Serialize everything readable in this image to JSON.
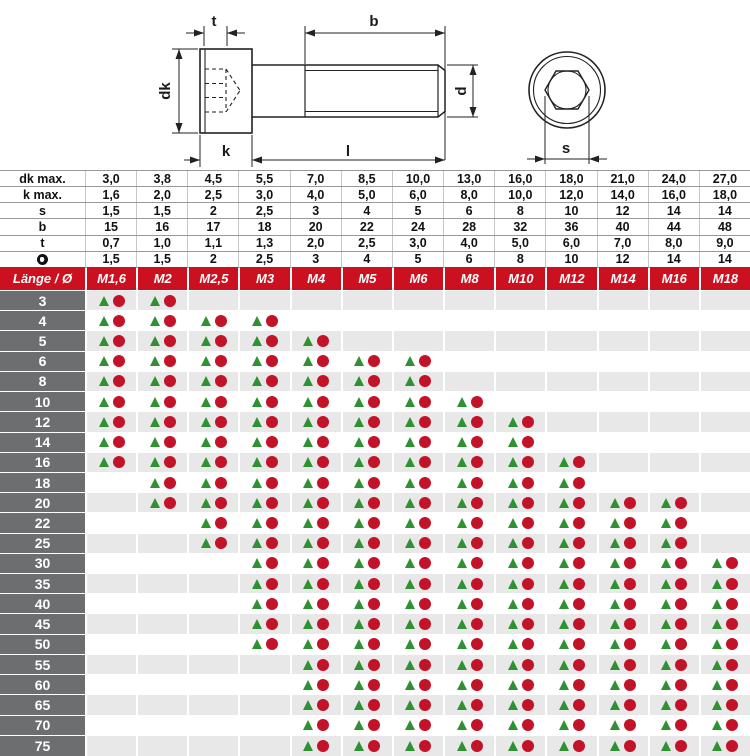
{
  "drawing": {
    "labels": {
      "socket_depth": "t",
      "thread_length": "b",
      "head_diameter": "dk",
      "shank_diameter": "d",
      "head_height": "k",
      "total_length": "l",
      "hex_width": "s"
    }
  },
  "spec_table": {
    "rows": [
      {
        "label": "dk max.",
        "values": [
          "3,0",
          "3,8",
          "4,5",
          "5,5",
          "7,0",
          "8,5",
          "10,0",
          "13,0",
          "16,0",
          "18,0",
          "21,0",
          "24,0",
          "27,0"
        ]
      },
      {
        "label": "k max.",
        "values": [
          "1,6",
          "2,0",
          "2,5",
          "3,0",
          "4,0",
          "5,0",
          "6,0",
          "8,0",
          "10,0",
          "12,0",
          "14,0",
          "16,0",
          "18,0"
        ]
      },
      {
        "label": "s",
        "values": [
          "1,5",
          "1,5",
          "2",
          "2,5",
          "3",
          "4",
          "5",
          "6",
          "8",
          "10",
          "12",
          "14",
          "14"
        ]
      },
      {
        "label": "b",
        "values": [
          "15",
          "16",
          "17",
          "18",
          "20",
          "22",
          "24",
          "28",
          "32",
          "36",
          "40",
          "44",
          "48"
        ]
      },
      {
        "label": "t",
        "values": [
          "0,7",
          "1,0",
          "1,1",
          "1,3",
          "2,0",
          "2,5",
          "3,0",
          "4,0",
          "5,0",
          "6,0",
          "7,0",
          "8,0",
          "9,0"
        ]
      },
      {
        "label": "",
        "icon": "hex-socket-icon",
        "values": [
          "1,5",
          "1,5",
          "2",
          "2,5",
          "3",
          "4",
          "5",
          "6",
          "8",
          "10",
          "12",
          "14",
          "14"
        ]
      }
    ]
  },
  "matrix": {
    "corner_label": "Länge / Ø",
    "columns": [
      "M1,6",
      "M2",
      "M2,5",
      "M3",
      "M4",
      "M5",
      "M6",
      "M8",
      "M10",
      "M12",
      "M14",
      "M16",
      "M18"
    ],
    "rows": [
      {
        "length": "3",
        "available": [
          1,
          1,
          0,
          0,
          0,
          0,
          0,
          0,
          0,
          0,
          0,
          0,
          0
        ]
      },
      {
        "length": "4",
        "available": [
          1,
          1,
          1,
          1,
          0,
          0,
          0,
          0,
          0,
          0,
          0,
          0,
          0
        ]
      },
      {
        "length": "5",
        "available": [
          1,
          1,
          1,
          1,
          1,
          0,
          0,
          0,
          0,
          0,
          0,
          0,
          0
        ]
      },
      {
        "length": "6",
        "available": [
          1,
          1,
          1,
          1,
          1,
          1,
          1,
          0,
          0,
          0,
          0,
          0,
          0
        ]
      },
      {
        "length": "8",
        "available": [
          1,
          1,
          1,
          1,
          1,
          1,
          1,
          0,
          0,
          0,
          0,
          0,
          0
        ]
      },
      {
        "length": "10",
        "available": [
          1,
          1,
          1,
          1,
          1,
          1,
          1,
          1,
          0,
          0,
          0,
          0,
          0
        ]
      },
      {
        "length": "12",
        "available": [
          1,
          1,
          1,
          1,
          1,
          1,
          1,
          1,
          1,
          0,
          0,
          0,
          0
        ]
      },
      {
        "length": "14",
        "available": [
          1,
          1,
          1,
          1,
          1,
          1,
          1,
          1,
          1,
          0,
          0,
          0,
          0
        ]
      },
      {
        "length": "16",
        "available": [
          1,
          1,
          1,
          1,
          1,
          1,
          1,
          1,
          1,
          1,
          0,
          0,
          0
        ]
      },
      {
        "length": "18",
        "available": [
          0,
          1,
          1,
          1,
          1,
          1,
          1,
          1,
          1,
          1,
          0,
          0,
          0
        ]
      },
      {
        "length": "20",
        "available": [
          0,
          1,
          1,
          1,
          1,
          1,
          1,
          1,
          1,
          1,
          1,
          1,
          0
        ]
      },
      {
        "length": "22",
        "available": [
          0,
          0,
          1,
          1,
          1,
          1,
          1,
          1,
          1,
          1,
          1,
          1,
          0
        ]
      },
      {
        "length": "25",
        "available": [
          0,
          0,
          1,
          1,
          1,
          1,
          1,
          1,
          1,
          1,
          1,
          1,
          0
        ]
      },
      {
        "length": "30",
        "available": [
          0,
          0,
          0,
          1,
          1,
          1,
          1,
          1,
          1,
          1,
          1,
          1,
          1
        ]
      },
      {
        "length": "35",
        "available": [
          0,
          0,
          0,
          1,
          1,
          1,
          1,
          1,
          1,
          1,
          1,
          1,
          1
        ]
      },
      {
        "length": "40",
        "available": [
          0,
          0,
          0,
          1,
          1,
          1,
          1,
          1,
          1,
          1,
          1,
          1,
          1
        ]
      },
      {
        "length": "45",
        "available": [
          0,
          0,
          0,
          1,
          1,
          1,
          1,
          1,
          1,
          1,
          1,
          1,
          1
        ]
      },
      {
        "length": "50",
        "available": [
          0,
          0,
          0,
          1,
          1,
          1,
          1,
          1,
          1,
          1,
          1,
          1,
          1
        ]
      },
      {
        "length": "55",
        "available": [
          0,
          0,
          0,
          0,
          1,
          1,
          1,
          1,
          1,
          1,
          1,
          1,
          1
        ]
      },
      {
        "length": "60",
        "available": [
          0,
          0,
          0,
          0,
          1,
          1,
          1,
          1,
          1,
          1,
          1,
          1,
          1
        ]
      },
      {
        "length": "65",
        "available": [
          0,
          0,
          0,
          0,
          1,
          1,
          1,
          1,
          1,
          1,
          1,
          1,
          1
        ]
      },
      {
        "length": "70",
        "available": [
          0,
          0,
          0,
          0,
          1,
          1,
          1,
          1,
          1,
          1,
          1,
          1,
          1
        ]
      },
      {
        "length": "75",
        "available": [
          0,
          0,
          0,
          0,
          1,
          1,
          1,
          1,
          1,
          1,
          1,
          1,
          1
        ]
      }
    ]
  },
  "colors": {
    "header_red": "#cb1120",
    "marker_circle_red": "#c31328",
    "marker_triangle_green": "#2f9132",
    "row_label_gray": "#6c6e70",
    "row_shade_gray": "#e8e8e8"
  }
}
